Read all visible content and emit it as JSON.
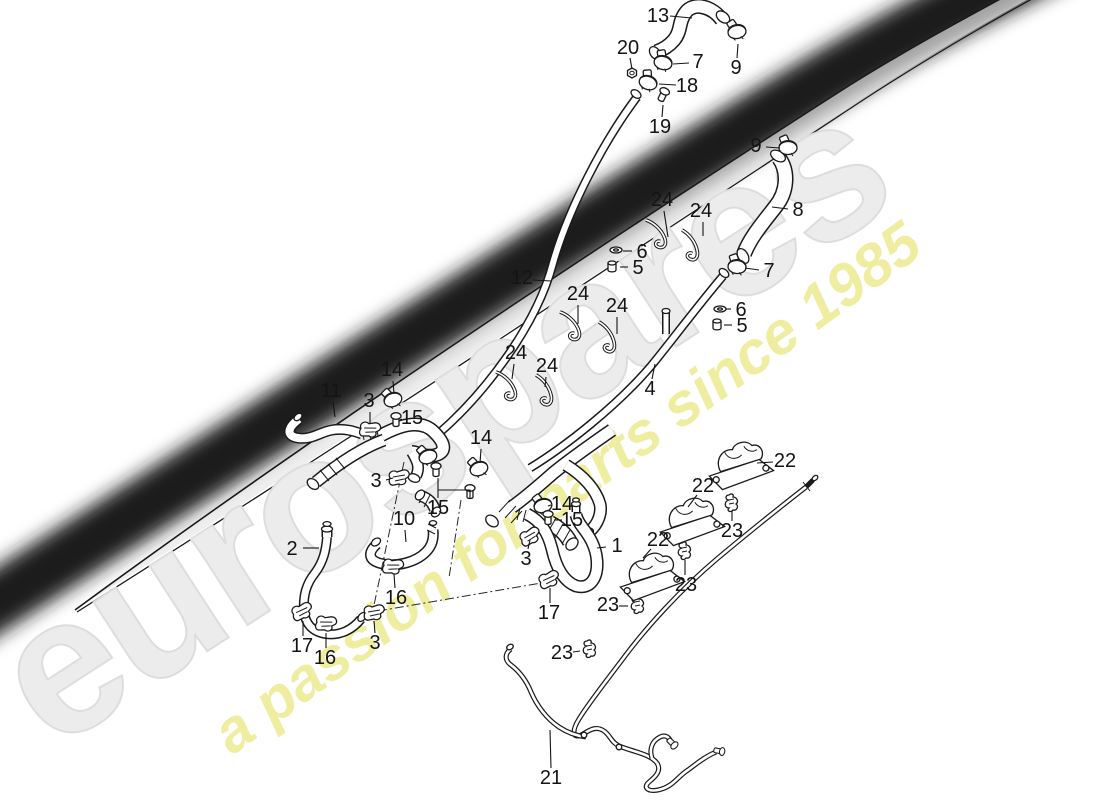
{
  "watermark": {
    "brand": "eurospares",
    "tagline": "a passion for parts since 1985",
    "brand_color": "#ececec",
    "tagline_color": "#efeda0"
  },
  "diagram": {
    "ink_color": "#1a1a1a",
    "label_color": "#141414",
    "label_font_px": 20,
    "callouts": [
      {
        "n": "13",
        "x": 658,
        "y": 16,
        "lead": [
          [
            [
              670,
              16
            ],
            [
              692,
              18
            ]
          ]
        ]
      },
      {
        "n": "20",
        "x": 628,
        "y": 48,
        "lead": [
          [
            [
              630,
              58
            ],
            [
              632,
              69
            ]
          ]
        ]
      },
      {
        "n": "7",
        "x": 698,
        "y": 62,
        "lead": [
          [
            [
              689,
              63
            ],
            [
              673,
              64
            ]
          ]
        ]
      },
      {
        "n": "9",
        "x": 736,
        "y": 68,
        "lead": [
          [
            [
              737,
              58
            ],
            [
              738,
              44
            ]
          ]
        ]
      },
      {
        "n": "18",
        "x": 687,
        "y": 86,
        "lead": [
          [
            [
              676,
              85
            ],
            [
              659,
              84
            ]
          ]
        ]
      },
      {
        "n": "19",
        "x": 660,
        "y": 127,
        "lead": [
          [
            [
              662,
              117
            ],
            [
              663,
              105
            ]
          ]
        ]
      },
      {
        "n": "9",
        "x": 756,
        "y": 146,
        "lead": [
          [
            [
              766,
              147
            ],
            [
              780,
              148
            ]
          ]
        ]
      },
      {
        "n": "8",
        "x": 798,
        "y": 210,
        "lead": [
          [
            [
              788,
              209
            ],
            [
              772,
              207
            ]
          ]
        ]
      },
      {
        "n": "24",
        "x": 662,
        "y": 200,
        "lead": [
          [
            [
              664,
              211
            ],
            [
              668,
              237
            ]
          ]
        ]
      },
      {
        "n": "24",
        "x": 701,
        "y": 211,
        "lead": [
          [
            [
              703,
              222
            ],
            [
              703,
              236
            ]
          ]
        ]
      },
      {
        "n": "6",
        "x": 642,
        "y": 252,
        "lead": [
          [
            [
              632,
              251
            ],
            [
              623,
              251
            ]
          ]
        ]
      },
      {
        "n": "5",
        "x": 638,
        "y": 268,
        "lead": [
          [
            [
              628,
              267
            ],
            [
              620,
              267
            ]
          ]
        ]
      },
      {
        "n": "12",
        "x": 522,
        "y": 278,
        "lead": [
          [
            [
              533,
              280
            ],
            [
              551,
              281
            ]
          ]
        ]
      },
      {
        "n": "24",
        "x": 578,
        "y": 294,
        "lead": [
          [
            [
              578,
              305
            ],
            [
              578,
              324
            ]
          ]
        ]
      },
      {
        "n": "24",
        "x": 617,
        "y": 306,
        "lead": [
          [
            [
              617,
              317
            ],
            [
              617,
              334
            ]
          ]
        ]
      },
      {
        "n": "7",
        "x": 769,
        "y": 271,
        "lead": [
          [
            [
              759,
              270
            ],
            [
              745,
              268
            ]
          ]
        ]
      },
      {
        "n": "6",
        "x": 741,
        "y": 310,
        "lead": [
          [
            [
              731,
              309
            ],
            [
              726,
              309
            ]
          ]
        ]
      },
      {
        "n": "5",
        "x": 742,
        "y": 326,
        "lead": [
          [
            [
              732,
              325
            ],
            [
              724,
              325
            ]
          ]
        ]
      },
      {
        "n": "4",
        "x": 650,
        "y": 389,
        "lead": [
          [
            [
              652,
              379
            ],
            [
              655,
              364
            ]
          ]
        ]
      },
      {
        "n": "24",
        "x": 516,
        "y": 353,
        "lead": [
          [
            [
              514,
              364
            ],
            [
              512,
              379
            ]
          ]
        ]
      },
      {
        "n": "24",
        "x": 547,
        "y": 366,
        "lead": [
          [
            [
              546,
              377
            ],
            [
              545,
              387
            ]
          ]
        ]
      },
      {
        "n": "14",
        "x": 392,
        "y": 370,
        "lead": [
          [
            [
              393,
              381
            ],
            [
              394,
              394
            ]
          ]
        ]
      },
      {
        "n": "11",
        "x": 331,
        "y": 391,
        "lead": [
          [
            [
              333,
              402
            ],
            [
              335,
              417
            ]
          ]
        ]
      },
      {
        "n": "3",
        "x": 369,
        "y": 401,
        "lead": [
          [
            [
              370,
              412
            ],
            [
              370,
              423
            ]
          ]
        ]
      },
      {
        "n": "15",
        "x": 412,
        "y": 418,
        "lead": [
          [
            [
              402,
              419
            ],
            [
              400,
              420
            ]
          ]
        ]
      },
      {
        "n": "14",
        "x": 481,
        "y": 438,
        "lead": [
          [
            [
              481,
              449
            ],
            [
              480,
              463
            ]
          ]
        ]
      },
      {
        "n": "3",
        "x": 376,
        "y": 481,
        "lead": [
          [
            [
              386,
              480
            ],
            [
              393,
              478
            ]
          ]
        ]
      },
      {
        "n": "15",
        "x": 438,
        "y": 508,
        "lead": [
          [
            [
              438,
              498
            ],
            [
              438,
              490
            ],
            [
              470,
              490
            ],
            [
              470,
              498
            ]
          ],
          [
            [
              438,
              490
            ],
            [
              438,
              478
            ]
          ]
        ]
      },
      {
        "n": "10",
        "x": 404,
        "y": 519,
        "lead": [
          [
            [
              405,
              530
            ],
            [
              406,
              542
            ]
          ]
        ]
      },
      {
        "n": "2",
        "x": 292,
        "y": 549,
        "lead": [
          [
            [
              303,
              548
            ],
            [
              319,
              548
            ]
          ]
        ]
      },
      {
        "n": "14",
        "x": 562,
        "y": 504,
        "lead": [
          [
            [
              551,
              505
            ],
            [
              548,
              506
            ]
          ]
        ]
      },
      {
        "n": "15",
        "x": 572,
        "y": 520,
        "lead": [
          [
            [
              562,
              520
            ],
            [
              554,
              520
            ]
          ]
        ]
      },
      {
        "n": "3",
        "x": 526,
        "y": 559,
        "lead": [
          [
            [
              528,
              549
            ],
            [
              530,
              540
            ]
          ]
        ]
      },
      {
        "n": "1",
        "x": 617,
        "y": 546,
        "lead": [
          [
            [
              606,
              547
            ],
            [
              597,
              548
            ]
          ]
        ]
      },
      {
        "n": "17",
        "x": 549,
        "y": 613,
        "lead": [
          [
            [
              550,
              603
            ],
            [
              550,
              588
            ]
          ]
        ]
      },
      {
        "n": "22",
        "x": 785,
        "y": 461,
        "lead": [
          [
            [
              773,
              462
            ],
            [
              757,
              463
            ]
          ]
        ]
      },
      {
        "n": "22",
        "x": 703,
        "y": 486,
        "lead": [
          [
            [
              697,
              495
            ],
            [
              688,
              507
            ]
          ]
        ]
      },
      {
        "n": "23",
        "x": 732,
        "y": 531,
        "lead": [
          [
            [
              732,
              521
            ],
            [
              732,
              511
            ]
          ]
        ]
      },
      {
        "n": "22",
        "x": 658,
        "y": 540,
        "lead": [
          [
            [
              651,
              549
            ],
            [
              643,
              558
            ]
          ]
        ]
      },
      {
        "n": "23",
        "x": 686,
        "y": 585,
        "lead": [
          [
            [
              685,
              575
            ],
            [
              685,
              560
            ]
          ]
        ]
      },
      {
        "n": "23",
        "x": 608,
        "y": 605,
        "lead": [
          [
            [
              619,
              606
            ],
            [
              628,
              606
            ]
          ]
        ]
      },
      {
        "n": "17",
        "x": 302,
        "y": 646,
        "lead": [
          [
            [
              303,
              636
            ],
            [
              303,
              621
            ]
          ]
        ]
      },
      {
        "n": "16",
        "x": 325,
        "y": 658,
        "lead": [
          [
            [
              326,
              648
            ],
            [
              326,
              633
            ]
          ]
        ]
      },
      {
        "n": "3",
        "x": 375,
        "y": 643,
        "lead": [
          [
            [
              375,
              633
            ],
            [
              374,
              621
            ]
          ]
        ]
      },
      {
        "n": "16",
        "x": 396,
        "y": 598,
        "lead": [
          [
            [
              395,
              588
            ],
            [
              394,
              574
            ]
          ]
        ]
      },
      {
        "n": "23",
        "x": 562,
        "y": 653,
        "lead": [
          [
            [
              573,
              652
            ],
            [
              580,
              651
            ]
          ]
        ]
      },
      {
        "n": "21",
        "x": 551,
        "y": 778,
        "lead": [
          [
            [
              551,
              768
            ],
            [
              550,
              730
            ]
          ]
        ]
      }
    ]
  }
}
